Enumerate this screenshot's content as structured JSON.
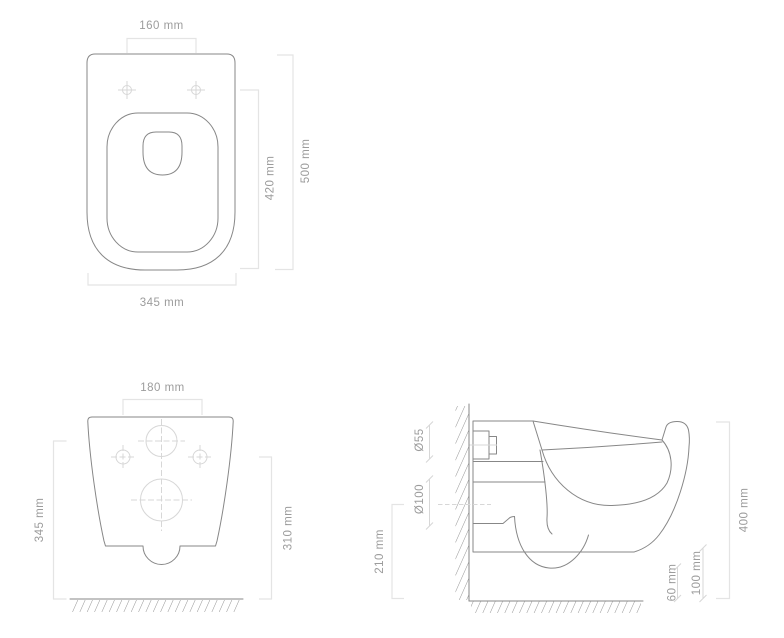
{
  "colors": {
    "outline": "#878787",
    "dimension_line": "#e4e4e4",
    "centerline": "#d7d7d7",
    "hatch": "#949494",
    "label_text": "#9c9c9c",
    "background": "#ffffff"
  },
  "views": {
    "top": {
      "dims": {
        "hole_spacing": "160 mm",
        "inner_length": "420 mm",
        "overall_length": "500 mm",
        "overall_width": "345 mm"
      }
    },
    "rear": {
      "dims": {
        "top_width": "180 mm",
        "inlet_height": "345 mm",
        "fixing_height": "310 mm"
      }
    },
    "side": {
      "dims": {
        "inlet_diameter": "Ø55",
        "outlet_diameter": "Ø100",
        "outlet_axis_height": "210 mm",
        "overall_height": "400 mm",
        "front_clearance": "60 mm",
        "bottom_clearance": "100 mm"
      }
    }
  }
}
